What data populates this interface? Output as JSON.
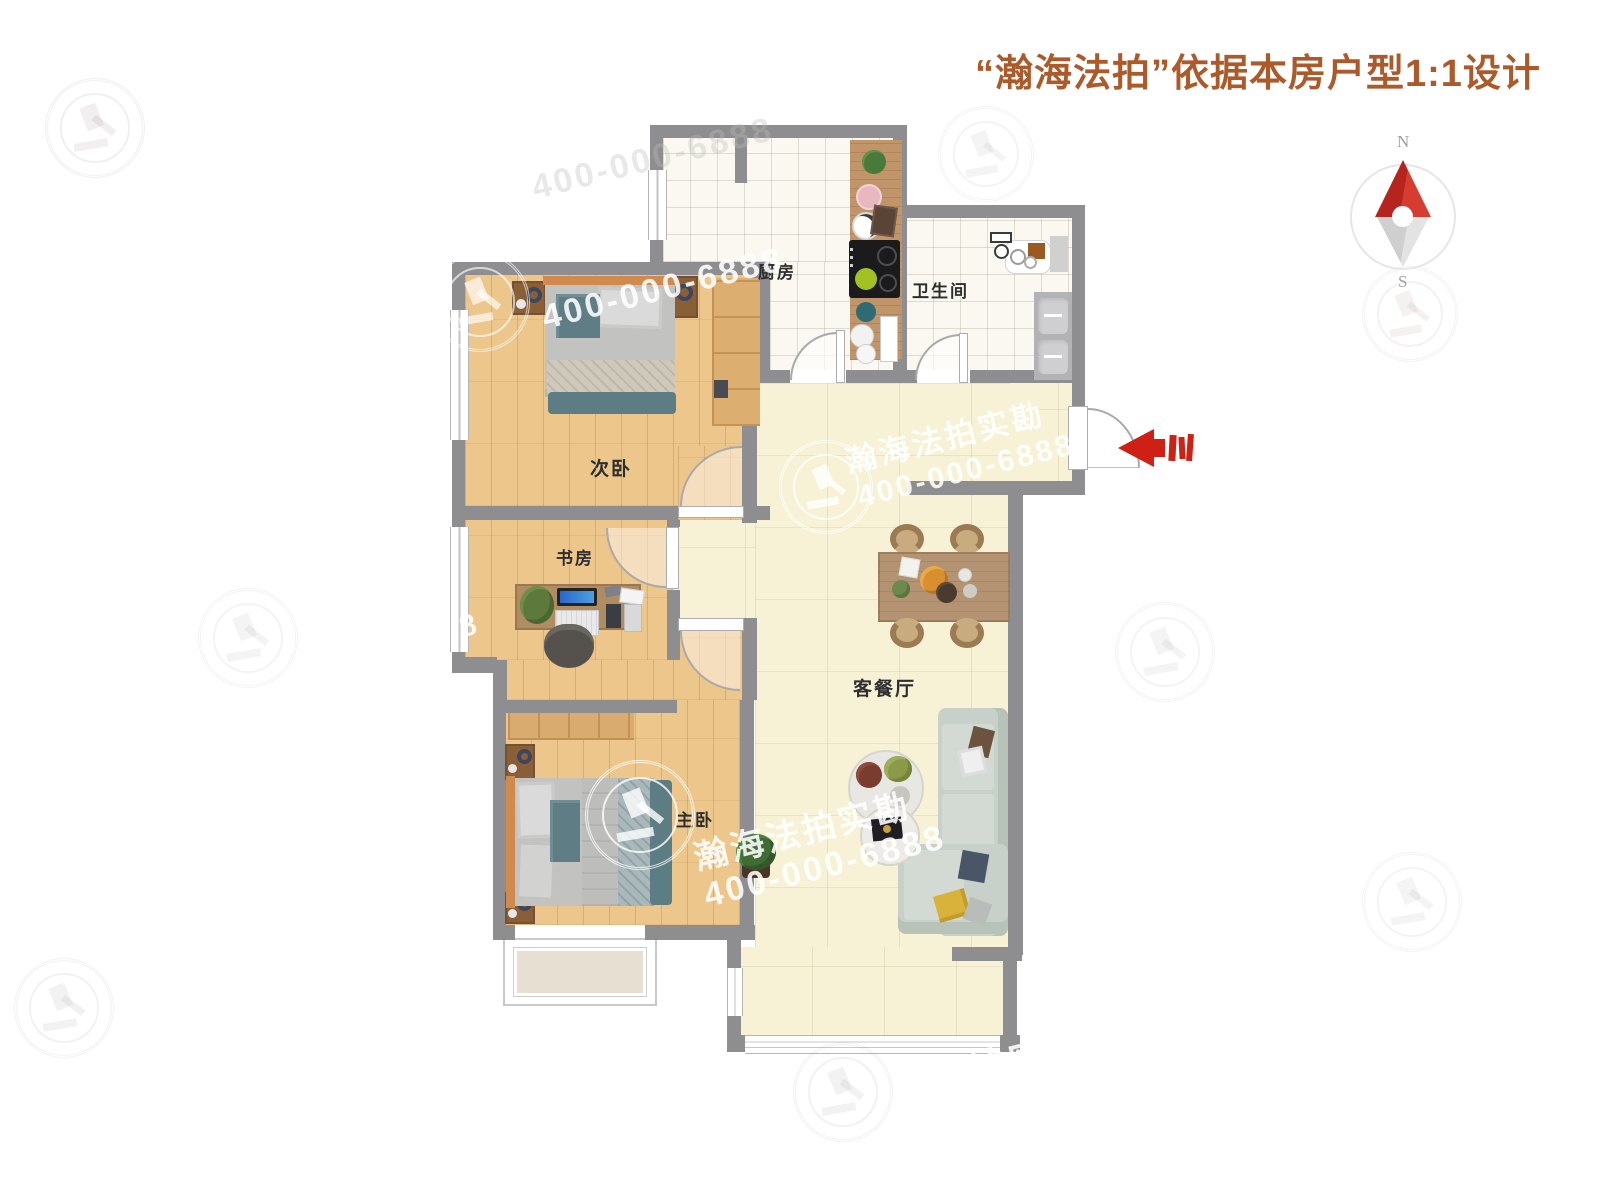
{
  "title": "“瀚海法拍”依据本房户型1:1设计",
  "compass": {
    "north": "N",
    "south": "S"
  },
  "rooms": {
    "kitchen": "厨房",
    "bathroom": "卫生间",
    "second_bedroom": "次卧",
    "study": "书房",
    "master_bedroom": "主卧",
    "living_dining": "客餐厅"
  },
  "watermark": {
    "brand": "瀚海法拍实勘",
    "phone": "400-000-6888",
    "brand_partial": "拍实",
    "phone_partial": "8"
  },
  "colors": {
    "title_text": "#ad5a2b",
    "wall": "#8e8e90",
    "wood_floor": "#edc68c",
    "tile_floor": "#faf8f0",
    "living_floor": "#f7f1d6",
    "compass_red": "#c5291f",
    "entry_arrow_red": "#cf2015",
    "sofa": "#c8d1c9",
    "counter_wood": "#c0956a"
  }
}
